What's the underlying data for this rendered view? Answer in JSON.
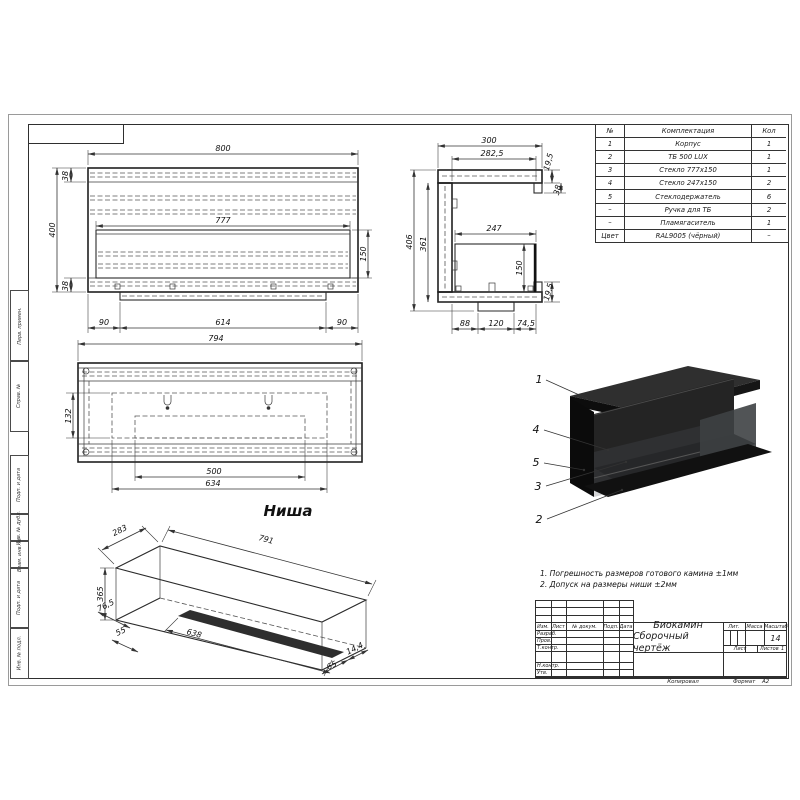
{
  "frame": {
    "margin_labels": [
      "Перв. примен.",
      "Справ. №",
      "Подп. и дата",
      "Инв. № дубл.",
      "Взам. инв. №",
      "Подп. и дата",
      "Инв. № подл."
    ]
  },
  "parts_table": {
    "headers": {
      "no": "№",
      "name": "Комплектация",
      "qty": "Кол"
    },
    "rows": [
      {
        "no": "1",
        "name": "Корпус",
        "qty": "1"
      },
      {
        "no": "2",
        "name": "ТБ 500 LUX",
        "qty": "1"
      },
      {
        "no": "3",
        "name": "Стекло 777х150",
        "qty": "1"
      },
      {
        "no": "4",
        "name": "Стекло 247х150",
        "qty": "2"
      },
      {
        "no": "5",
        "name": "Стеклодержатель",
        "qty": "6"
      },
      {
        "no": "–",
        "name": "Ручка для ТБ",
        "qty": "2"
      },
      {
        "no": "–",
        "name": "Пламягаситель",
        "qty": "1"
      },
      {
        "no": "Цвет",
        "name": "RAL9005 (чёрный)",
        "qty": "–"
      }
    ]
  },
  "front_view": {
    "w": "800",
    "top": "38",
    "height": "400",
    "bottom": "38",
    "inner_w": "777",
    "opening_h": "150",
    "left_m": "90",
    "base": "614",
    "right_m": "90"
  },
  "side_view": {
    "depth": "300",
    "inner_depth": "282,5",
    "top_gap": "19,5",
    "flange": "38",
    "height": "406",
    "inner_h": "361",
    "glass_w": "247",
    "glass_h": "150",
    "bottom_gap": "19,5",
    "b1": "88",
    "b2": "120",
    "b3": "74,5"
  },
  "plan_view": {
    "width": "794",
    "offset": "132",
    "slot": "500",
    "opening": "634",
    "label": "Ниша"
  },
  "iso_view": {
    "depth": "283",
    "length": "791",
    "height": "365",
    "m1": "76,5",
    "m2": "55",
    "slot": "638",
    "m3": "65",
    "m4": "14,4"
  },
  "callouts": [
    "1",
    "4",
    "5",
    "3",
    "2"
  ],
  "notes": [
    "1. Погрешность размеров готового камина ±1мм",
    "2. Допуск на размеры ниши ±2мм"
  ],
  "title_block": {
    "title_line1": "Биокамин",
    "title_line2": "Сборочный чертёж",
    "col_izm": "Изм.",
    "col_list": "Лист",
    "col_doc": "№ докум.",
    "col_sign": "Подп.",
    "col_date": "Дата",
    "row_develop": "Разраб.",
    "row_check": "Пров.",
    "row_tcontrol": "Т.контр.",
    "row_ncontrol": "Н.контр.",
    "row_approve": "Утв.",
    "lit": "Лит.",
    "mass": "Масса",
    "scale": "Масштаб",
    "scale_value": "14",
    "sheet": "Лист",
    "sheets": "Листов",
    "sheets_value": "1",
    "copied": "Копировал",
    "format": "Формат",
    "format_value": "А2"
  }
}
